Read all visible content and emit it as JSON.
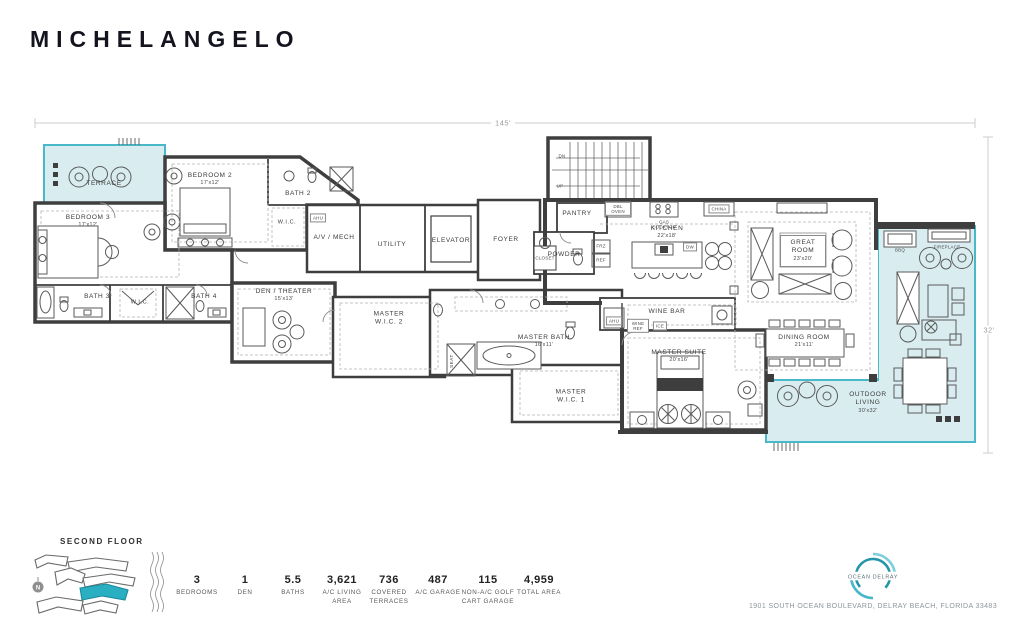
{
  "title": "MICHELANGELO",
  "dimensions": {
    "width": "145'",
    "depth": "32'"
  },
  "rooms": {
    "terrace": {
      "name": "TERRACE"
    },
    "bedroom2": {
      "name": "BEDROOM 2",
      "dims": "17'x12'"
    },
    "bedroom3": {
      "name": "BEDROOM 3",
      "dims": "17'x12'"
    },
    "bath2": {
      "name": "BATH 2"
    },
    "bath3": {
      "name": "BATH 3"
    },
    "bath4": {
      "name": "BATH 4"
    },
    "wic_bedroom2": {
      "name": "W.I.C."
    },
    "wic_bedroom3": {
      "name": "W.I.C."
    },
    "av_mech": {
      "name": "A/V / MECH"
    },
    "utility": {
      "name": "UTILITY"
    },
    "elevator": {
      "name": "ELEVATOR"
    },
    "foyer": {
      "name": "FOYER"
    },
    "pantry": {
      "name": "PANTRY"
    },
    "powder": {
      "name": "POWDER"
    },
    "closet": {
      "name": "CLOSET"
    },
    "kitchen": {
      "name": "KITCHEN",
      "dims": "22'x18'"
    },
    "great_room": {
      "name": "GREAT ROOM",
      "dims": "23'x20'"
    },
    "dining_room": {
      "name": "DINING ROOM",
      "dims": "21'x11'"
    },
    "wine_bar": {
      "name": "WINE BAR"
    },
    "den_theater": {
      "name": "DEN / THEATER",
      "dims": "15'x13'"
    },
    "master_suite": {
      "name": "MASTER SUITE",
      "dims": "20'x16'"
    },
    "master_bath": {
      "name": "MASTER BATH",
      "dims": "16'x11'"
    },
    "master_wic1": {
      "name": "MASTER W.I.C. 1"
    },
    "master_wic2": {
      "name": "MASTER W.I.C. 2"
    },
    "outdoor_living": {
      "name": "OUTDOOR LIVING",
      "dims": "30'x32'"
    }
  },
  "fixtures": {
    "dn": "DN",
    "up": "UP",
    "ahu": "AHU",
    "dbl_oven": "DBL OVEN",
    "gas_cooktop": "GAS COOKTOP",
    "china": "CHINA",
    "dw": "DW",
    "frz": "FRZ",
    "ref": "REF",
    "wine_ref": "WINE REF",
    "ice": "ICE",
    "seat": "SEAT",
    "bbq": "BBQ",
    "fireplace": "FIREPLACE"
  },
  "key_plan": {
    "label": "SECOND FLOOR",
    "north": "N"
  },
  "stats": [
    {
      "value": "3",
      "label": "BEDROOMS"
    },
    {
      "value": "1",
      "label": "DEN"
    },
    {
      "value": "5.5",
      "label": "BATHS"
    },
    {
      "value": "3,621",
      "label": "A/C LIVING AREA"
    },
    {
      "value": "736",
      "label": "COVERED TERRACES"
    },
    {
      "value": "487",
      "label": "A/C GARAGE"
    },
    {
      "value": "115",
      "label": "NON-A/C GOLF CART GARAGE"
    },
    {
      "value": "4,959",
      "label": "TOTAL AREA"
    }
  ],
  "footer": {
    "brand": "OCEAN DELRAY",
    "address": "1901 SOUTH OCEAN BOULEVARD, DELRAY BEACH, FLORIDA 33483"
  },
  "colors": {
    "accent_teal": "#49B8C8",
    "teal_fill": "#D9EDF1",
    "unit_highlight": "#2AAEC2",
    "wall": "#3E3E3E"
  }
}
